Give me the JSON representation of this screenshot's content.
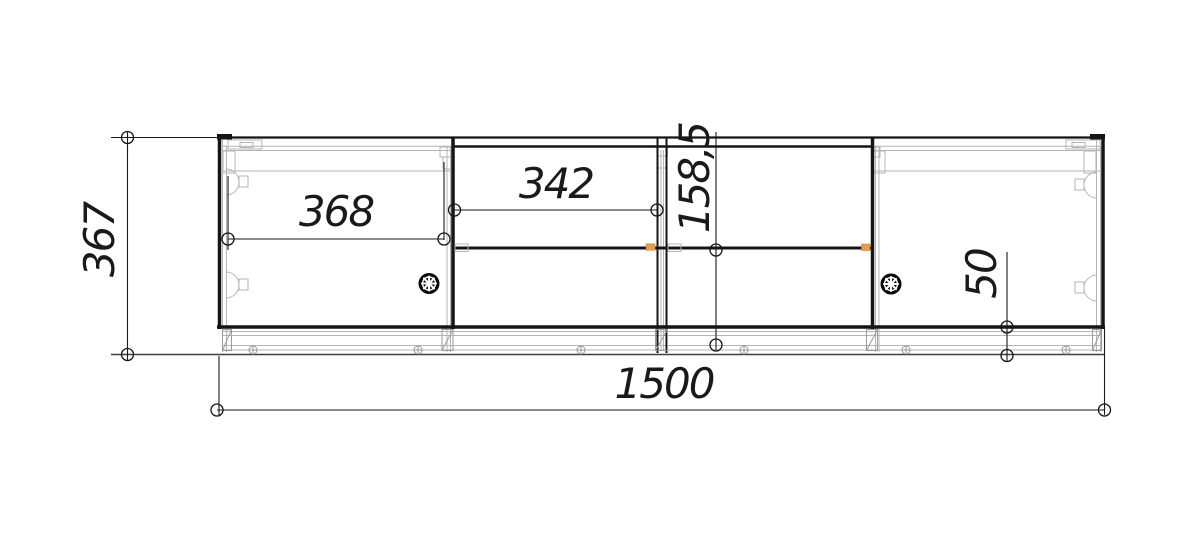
{
  "drawing": {
    "type": "furniture-assembly-drawing",
    "dim_overall_width": "1500",
    "dim_overall_height": "367",
    "dim_left_door_width": "368",
    "dim_drawer_width": "342",
    "dim_bottom_section_height": "158,5",
    "dim_plinth_height": "50",
    "colors": {
      "line": "#151515",
      "carcass": "#b5b5b5",
      "connector_highlight": "#ED9B40",
      "background": "#ffffff"
    }
  }
}
